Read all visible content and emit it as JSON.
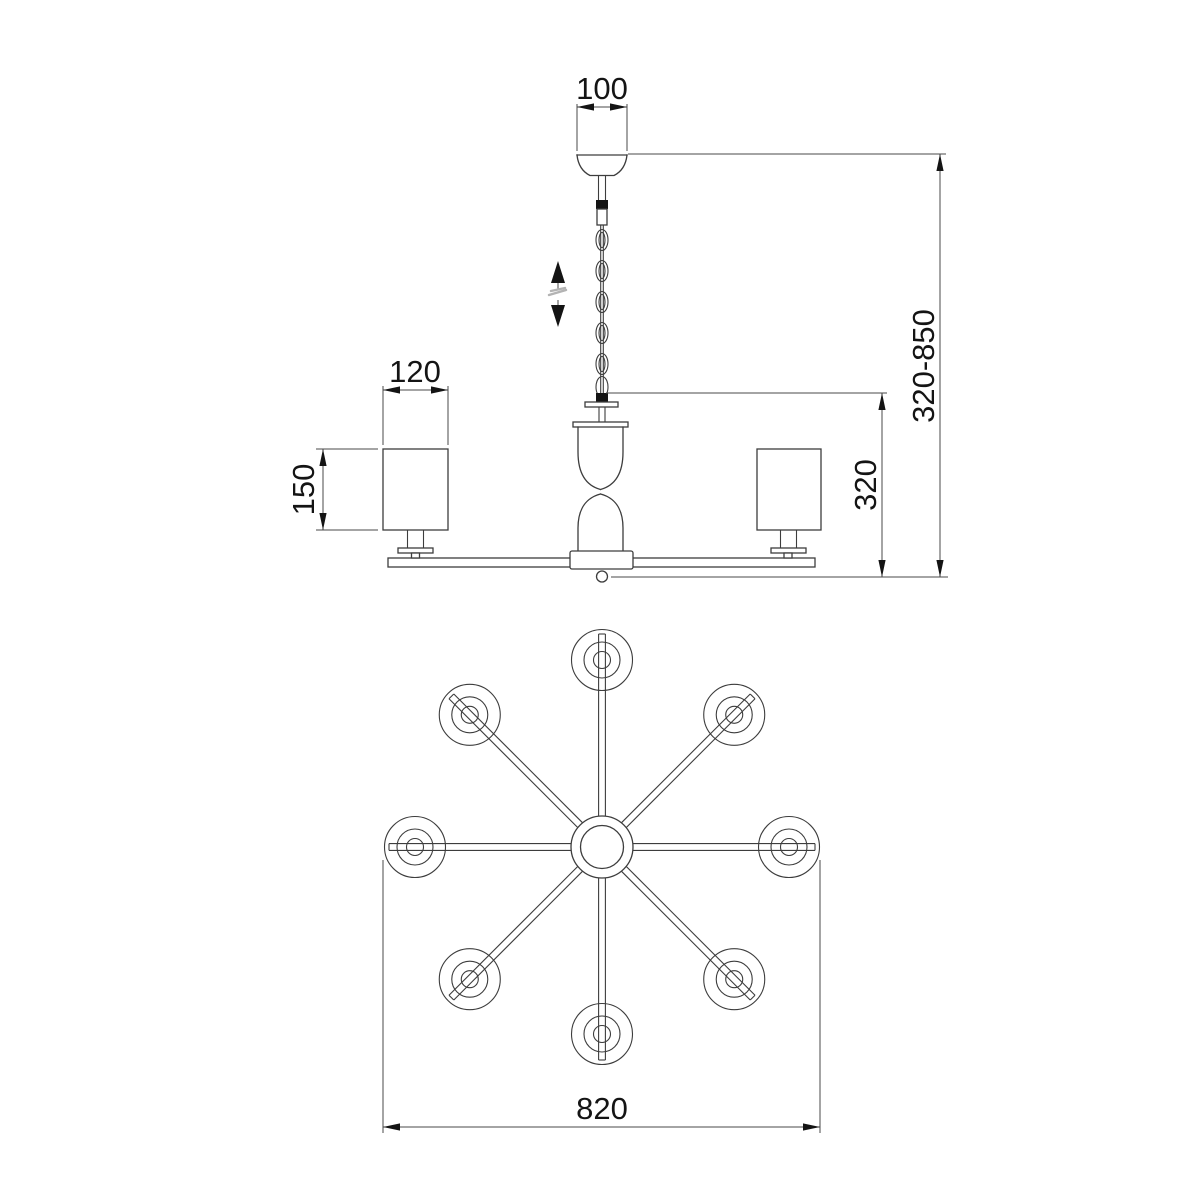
{
  "drawing": {
    "type": "technical-line-drawing",
    "subject": "8-arm chandelier dimension diagram, side elevation and bottom plan view",
    "colors": {
      "line": "#3d3d3d",
      "text": "#141414",
      "dim": "#4a4a4a",
      "muted": "#b3b3b3",
      "bg": "#ffffff"
    },
    "side_view": {
      "canopy_width": "100",
      "shade_width": "120",
      "shade_height": "150",
      "body_height": "320",
      "overall_height_range": "320-850",
      "height_adjustable": true
    },
    "plan_view": {
      "overall_diameter": "820",
      "arm_count": 8,
      "arm_angle_step_deg": 45
    }
  }
}
